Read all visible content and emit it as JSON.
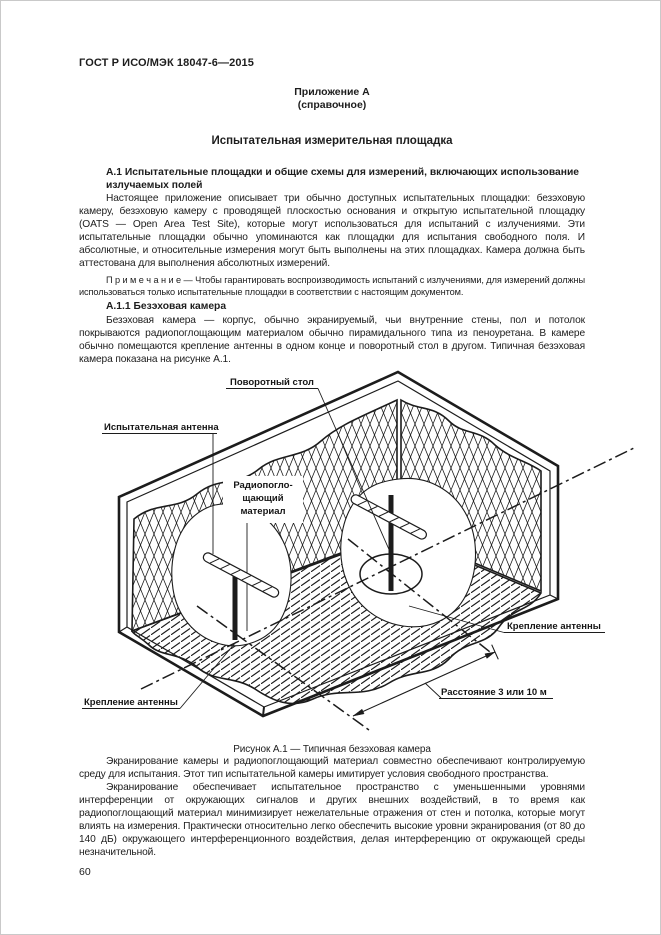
{
  "theme": {
    "ink": "#1d1d1d",
    "paper": "#ffffff"
  },
  "page": {
    "header": "ГОСТ Р ИСО/МЭК 18047-6—2015",
    "page_number": "60"
  },
  "annex": {
    "label": "Приложение А",
    "type": "(справочное)",
    "title": "Испытательная измерительная площадка"
  },
  "sections": {
    "a1": {
      "heading": "А.1 Испытательные площадки и общие схемы для измерений, включающих использование излучаемых полей",
      "paragraph": "Настоящее приложение описывает три обычно доступных испытательных площадки: безэховую камеру, безэховую камеру с проводящей плоскостью основания и открытую испытательной площадку (OATS — Open Area Test Site), которые могут использоваться для испытаний с излучениями. Эти испытательные площадки обычно упоминаются как площадки для испытания свободного поля. И абсолютные, и относительные измерения могут быть выполнены на этих площадках. Камера должна быть аттестована для выполнения абсолютных измерений.",
      "note": "П р и м е ч а н и е — Чтобы гарантировать воспроизводимость испытаний с излучениями, для измерений должны использоваться только испытательные площадки в соответствии с настоящим документом."
    },
    "a11": {
      "heading": "А.1.1 Безэховая камера",
      "paragraph": "Безэховая камера — корпус, обычно экранируемый, чьи внутренние стены, пол и потолок покрываются радиопоглощающим материалом обычно пирамидального типа из пеноуретана. В камере обычно помещаются крепление антенны в одном конце и поворотный стол в другом. Типичная безэховая камера показана на рисунке А.1."
    }
  },
  "figure": {
    "caption": "Рисунок А.1 — Типичная безэховая камера",
    "labels": {
      "rotary_table": "Поворотный стол",
      "test_antenna": "Испытательная антенна",
      "absorber_l1": "Радиопогло-",
      "absorber_l2": "щающий",
      "absorber_l3": "материал",
      "antenna_mount_right": "Крепление антенны",
      "antenna_mount_left": "Крепление антенны",
      "distance": "Расстояние 3 или 10 м"
    }
  },
  "closing": {
    "paragraph_1": "Экранирование камеры и радиопоглощающий материал совместно обеспечивают контролируемую среду для испытания. Этот тип испытательной камеры имитирует условия свободного пространства.",
    "paragraph_2": "Экранирование обеспечивает испытательное пространство с уменьшенными уровнями интерференции от окружающих сигналов и других внешних воздействий, в то время как радиопоглощающий материал минимизирует нежелательные отражения от стен и потолка, которые могут влиять на измерения. Практически относительно легко обеспечить высокие уровни экранирования (от 80 до 140 дБ) окружающего интерференционного воздействия, делая интерференцию от окружающей среды незначительной."
  }
}
